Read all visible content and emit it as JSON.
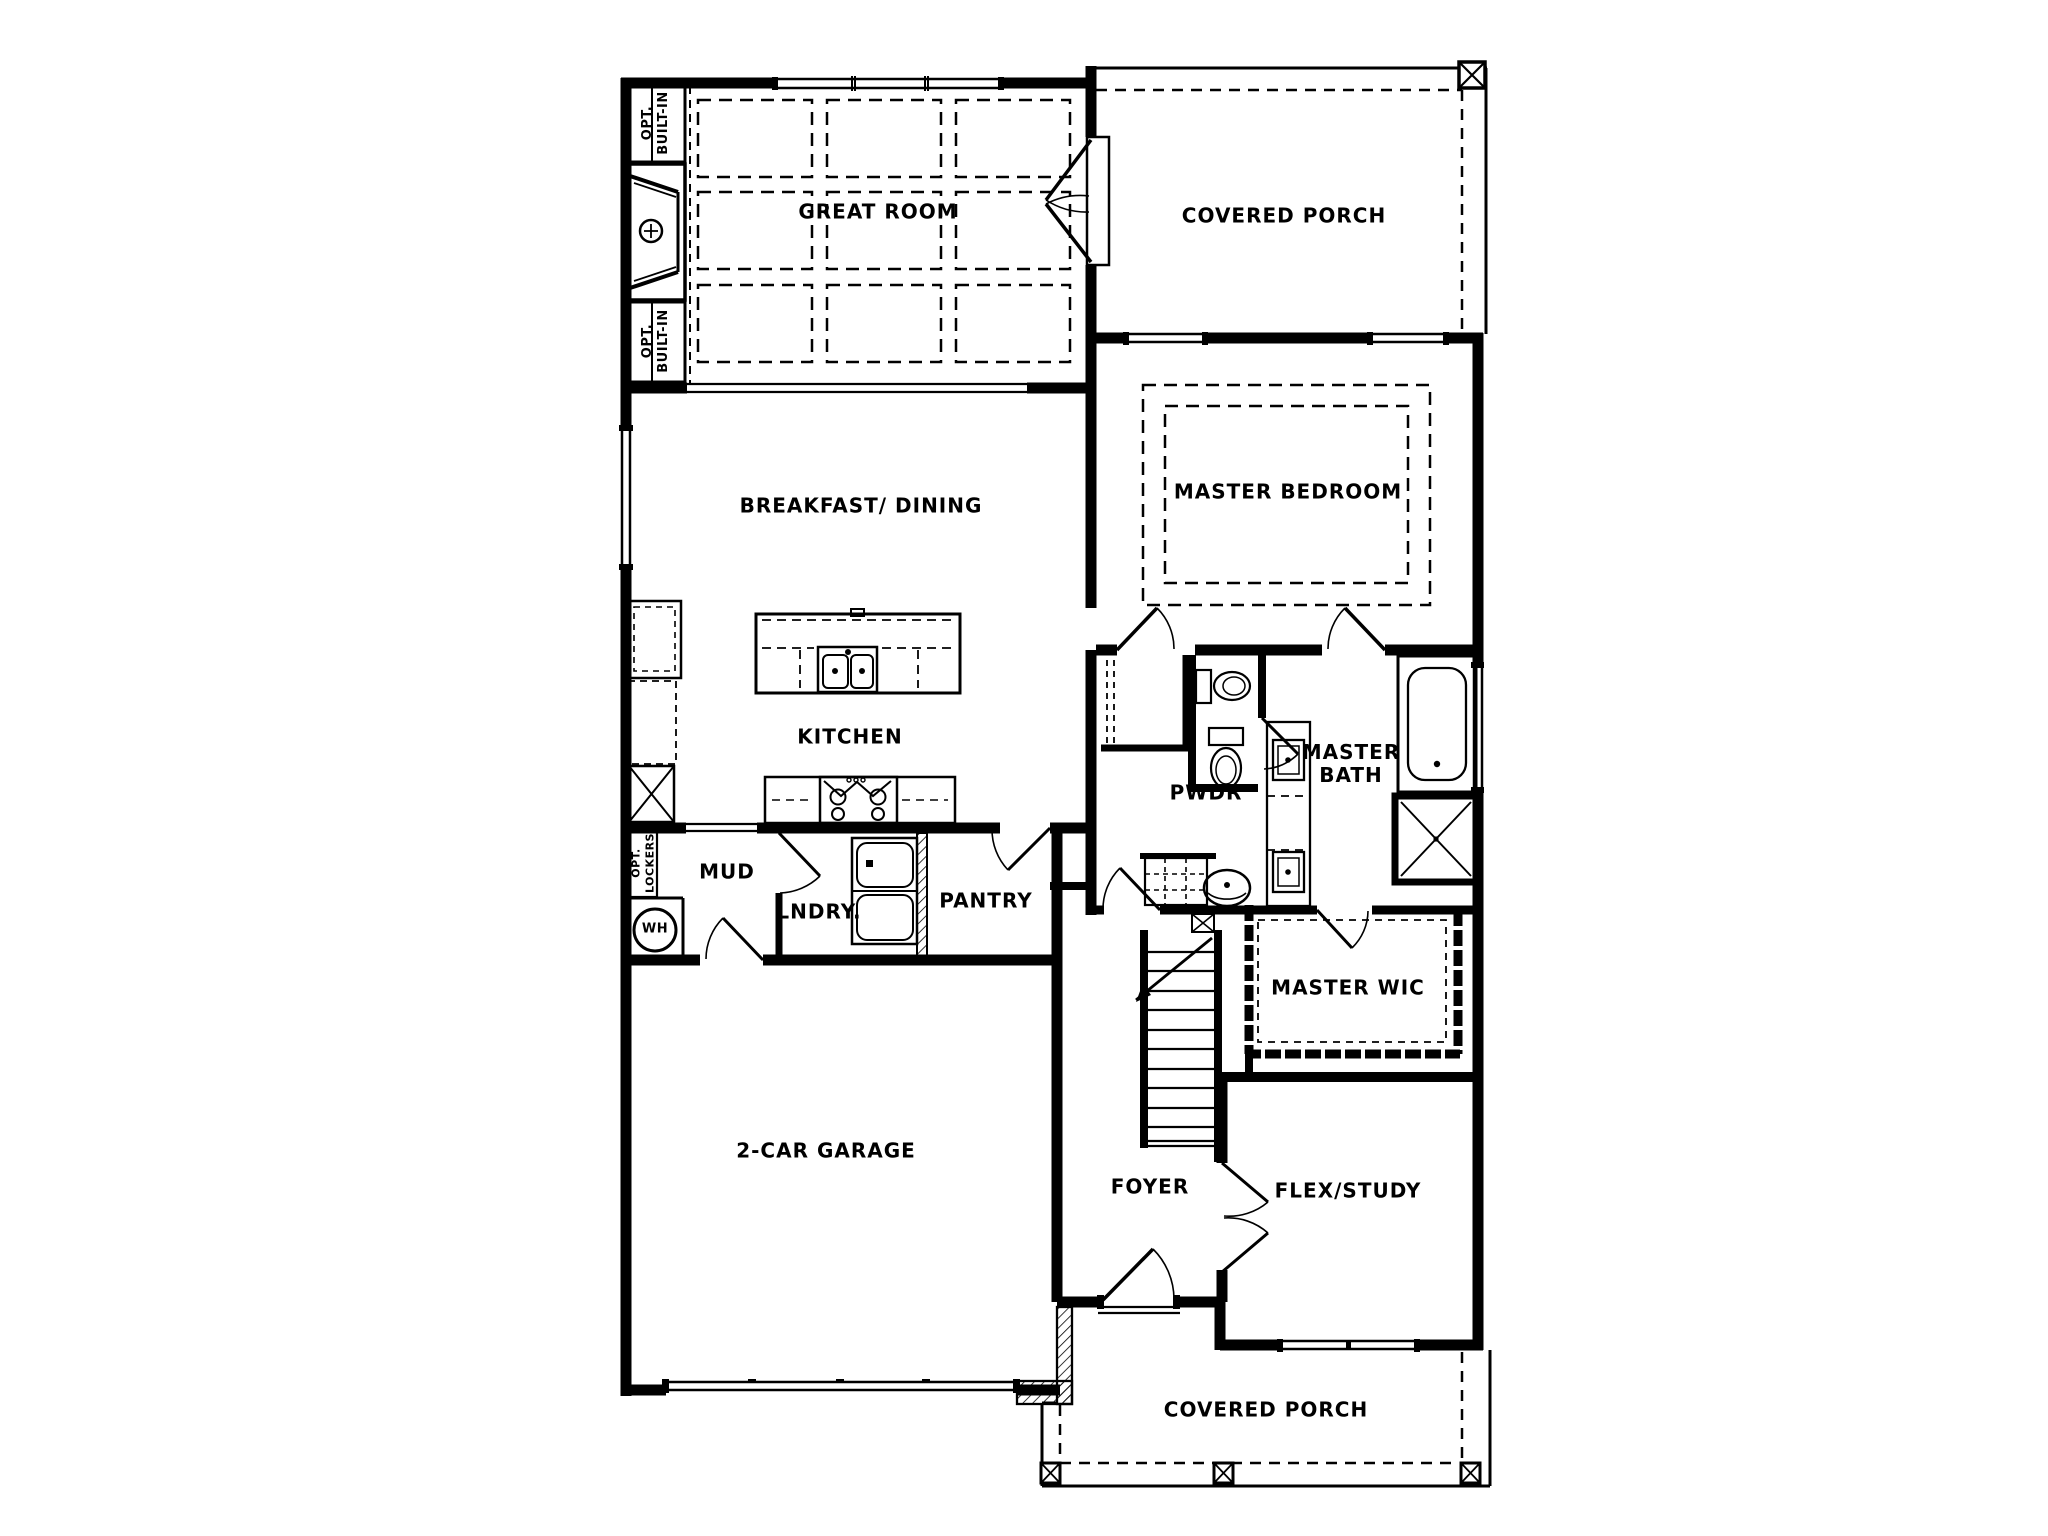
{
  "drawing": {
    "type": "single-family-home-first-floor-plan",
    "line_color": "#000000",
    "background_color": "#ffffff"
  },
  "rooms": {
    "great_room": "GREAT ROOM",
    "covered_porch_upper": "COVERED PORCH",
    "master_bedroom": "MASTER BEDROOM",
    "breakfast_dining": "BREAKFAST/ DINING",
    "kitchen": "KITCHEN",
    "mud": "MUD",
    "laundry": "LNDRY.",
    "pantry": "PANTRY",
    "powder": "PWDR",
    "master_bath": "MASTER\nBATH",
    "master_wic": "MASTER WIC",
    "garage": "2-CAR GARAGE",
    "foyer": "FOYER",
    "flex_study": "FLEX/STUDY",
    "covered_porch_lower": "COVERED PORCH"
  },
  "annotations": {
    "opt_built_in_upper": "OPT.\nBUILT-IN",
    "opt_built_in_lower": "OPT.\nBUILT-IN",
    "opt_lockers": "OPT.\nLOCKERS",
    "water_heater": "WH"
  }
}
